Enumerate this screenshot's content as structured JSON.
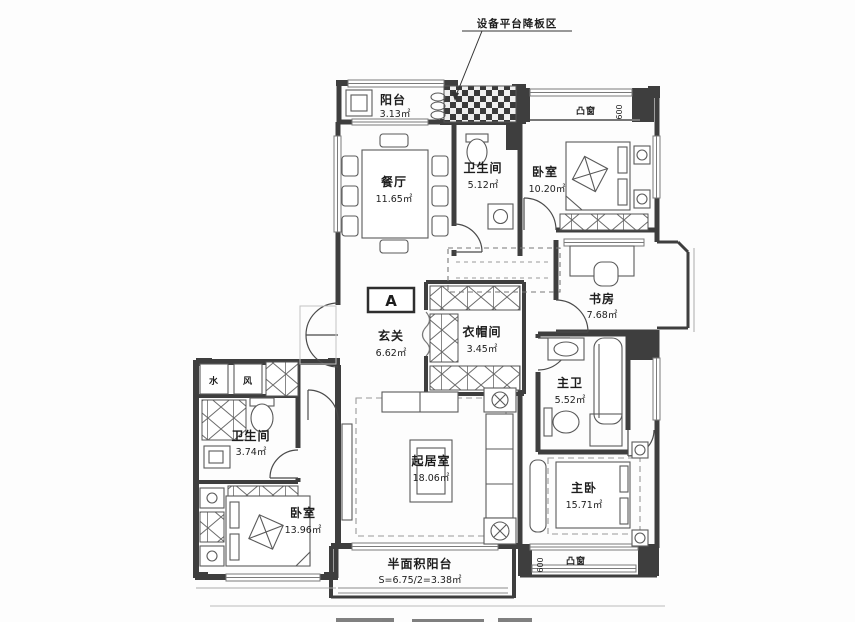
{
  "plan": {
    "unit_label": "A",
    "annotation": {
      "equipment_platform": "设备平台降板区"
    },
    "rooms": {
      "balcony": {
        "name": "阳台",
        "area": "3.13㎡"
      },
      "dining": {
        "name": "餐厅",
        "area": "11.65㎡"
      },
      "bath_top": {
        "name": "卫生间",
        "area": "5.12㎡"
      },
      "bedroom_top_right": {
        "name": "卧室",
        "area": "10.20㎡"
      },
      "study": {
        "name": "书房",
        "area": "7.68㎡"
      },
      "foyer": {
        "name": "玄关",
        "area": "6.62㎡"
      },
      "cloakroom": {
        "name": "衣帽间",
        "area": "3.45㎡"
      },
      "master_bath": {
        "name": "主卫",
        "area": "5.52㎡"
      },
      "bath_left": {
        "name": "卫生间",
        "area": "3.74㎡"
      },
      "living": {
        "name": "起居室",
        "area": "18.06㎡"
      },
      "master_bedroom": {
        "name": "主卧",
        "area": "15.71㎡"
      },
      "bedroom_bottom_left": {
        "name": "卧室",
        "area": "13.96㎡"
      },
      "half_balcony": {
        "name": "半面积阳台",
        "area": "S=6.75/2=3.38㎡"
      }
    },
    "shafts": {
      "water": "水",
      "wind": "风"
    },
    "bay_window_top": {
      "label": "凸窗",
      "dimension": "600"
    },
    "bay_window_bottom": {
      "label": "凸窗",
      "dimension": "600"
    },
    "colors": {
      "wall": "#3e3e3e",
      "line": "#555555",
      "background": "#fdfdfd"
    }
  }
}
